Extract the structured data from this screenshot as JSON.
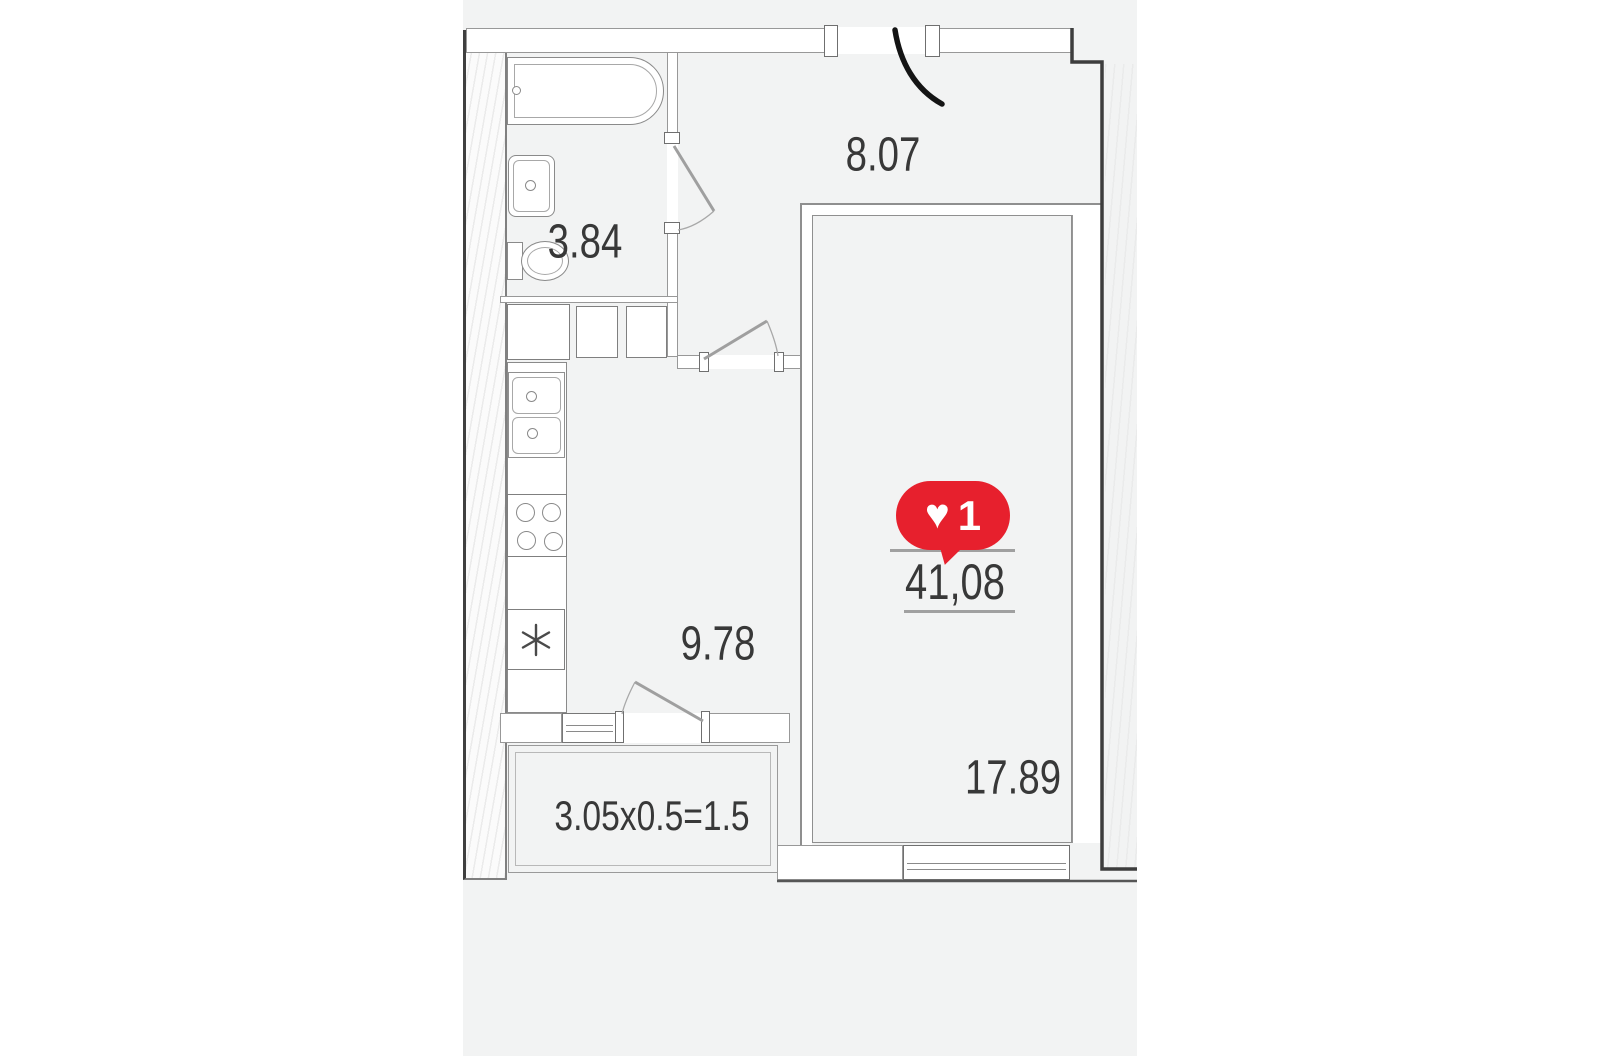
{
  "page": {
    "background": "#ffffff"
  },
  "plan": {
    "background": "#f2f3f3",
    "labels": {
      "bathroom_area": "3.84",
      "hallway_area": "8.07",
      "kitchen_area": "9.78",
      "living_room_area": "17.89",
      "total_area": "41,08",
      "balcony_dims": "3.05x0.5=1.5"
    },
    "like_badge": {
      "count": "1",
      "icon": "heart-icon",
      "icon_glyph": "♥",
      "color": "#e7202d"
    },
    "colors": {
      "wall_dark": "#3d3d3d",
      "line_gray": "#8f8f8f",
      "door_arc": "#141414",
      "floor": "#f2f3f3"
    }
  }
}
